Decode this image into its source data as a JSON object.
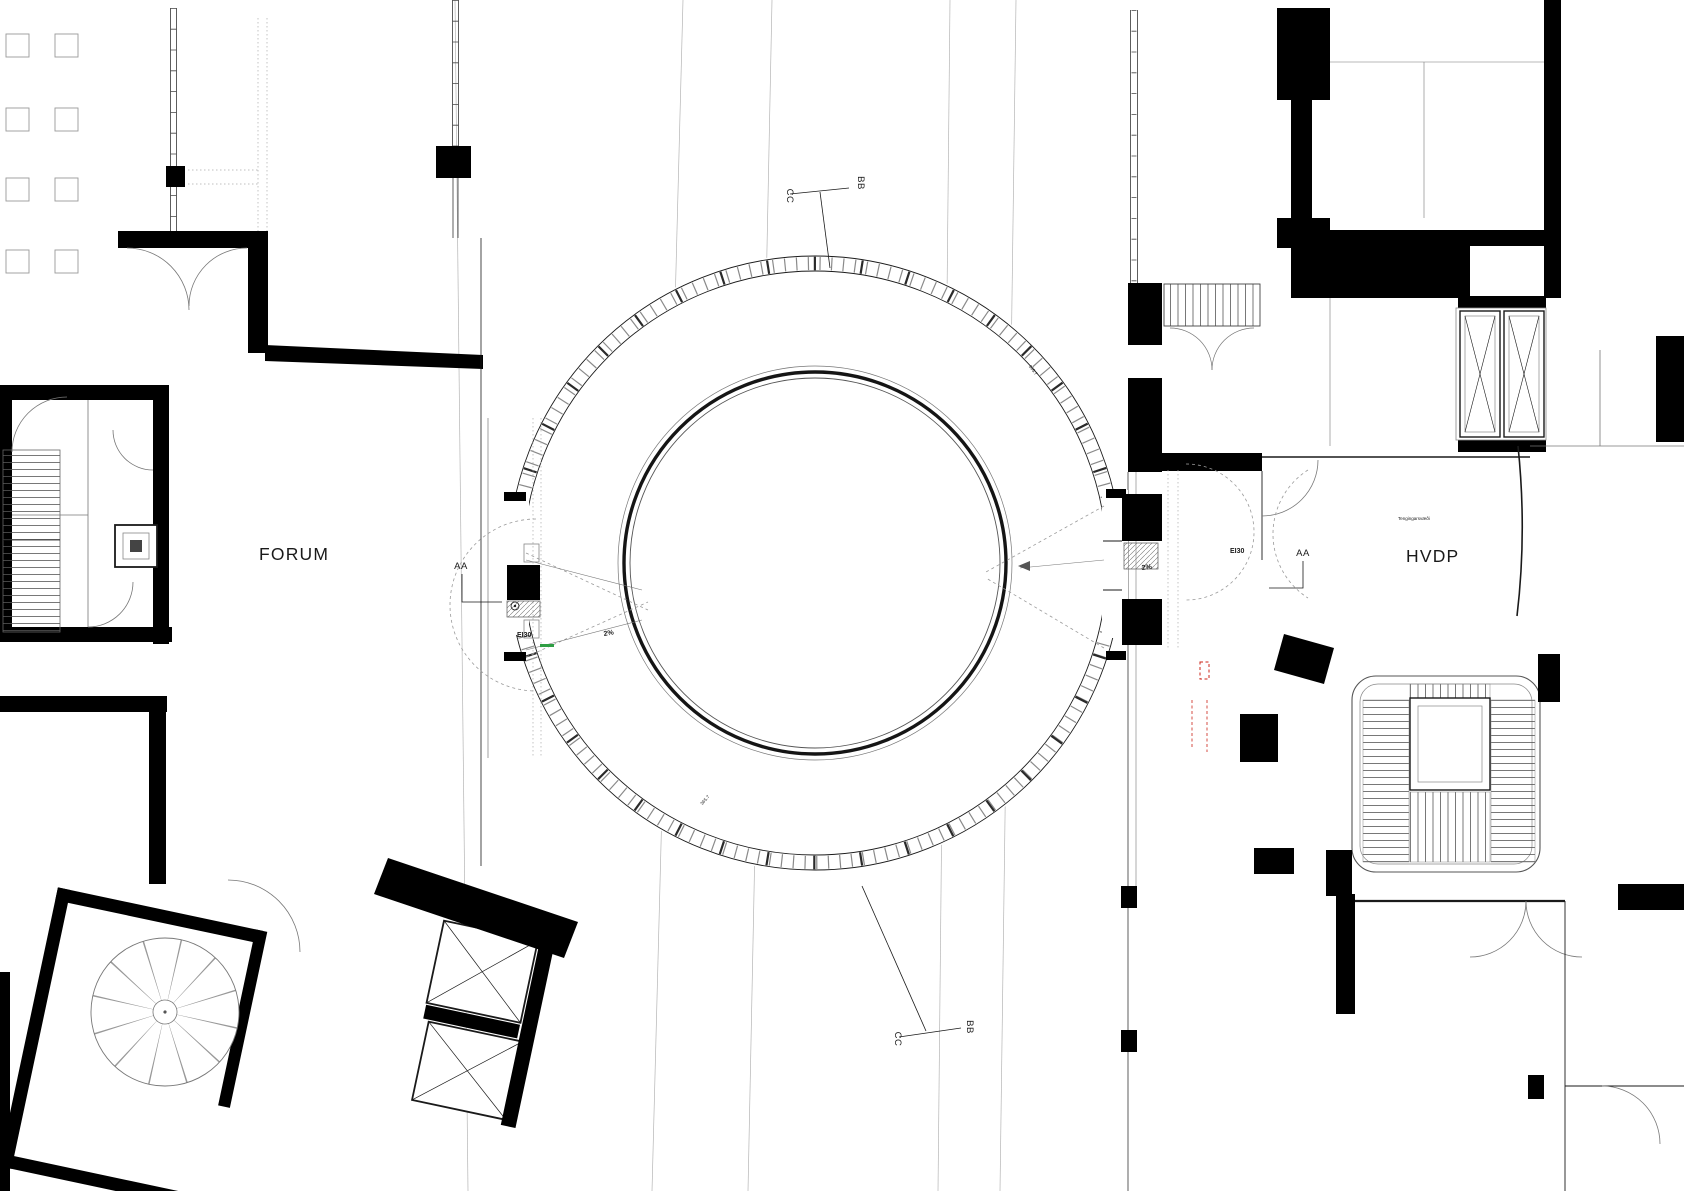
{
  "drawing": {
    "buildings": {
      "left": {
        "name": "FORUM"
      },
      "right": {
        "name": "HVDP",
        "zone_note": "Tengingarsvæði"
      }
    },
    "ring": {
      "fire_rating_left": "EI30",
      "fire_rating_right": "EI30",
      "slope_left": "2%",
      "slope_right": "2%",
      "spot_elevation_upper": "365.7",
      "spot_elevation_lower": "365.7"
    },
    "section_markers": {
      "aa_left": "AA",
      "aa_right": "AA",
      "bb_top": "BB",
      "cc_top": "CC",
      "bb_bottom": "BB",
      "cc_bottom": "CC"
    },
    "colors": {
      "ink": "#1a1a1a",
      "wall": "#000000",
      "light_line": "#b5b5b5",
      "accent_red": "#cc2418",
      "accent_green": "#2f9e44",
      "paper": "#ffffff"
    }
  }
}
